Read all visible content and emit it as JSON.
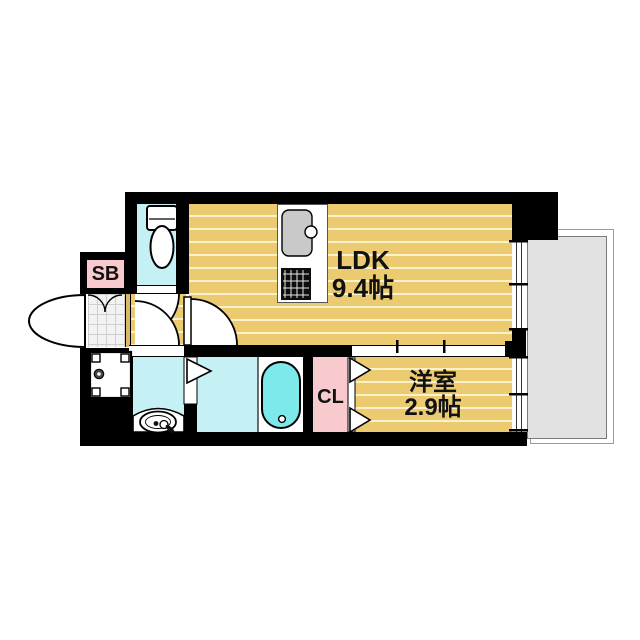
{
  "floorplan": {
    "rooms": {
      "ldk": {
        "label": "LDK",
        "size": "9.4帖"
      },
      "western_room": {
        "label": "洋室",
        "size": "2.9帖"
      },
      "closet": {
        "label": "CL"
      },
      "shoe_box": {
        "label": "SB"
      }
    },
    "icons": {
      "toilet-icon": "toilet fixture",
      "kitchen-sink-icon": "kitchen sink with faucet",
      "gas-stove-icon": "two-burner stove grate",
      "bathtub-icon": "bathtub",
      "washbasin-icon": "washbasin with faucet",
      "washing-machine-pan-icon": "washing machine pan with drain",
      "entrance-door-icon": "entrance door swing arc",
      "interior-door-icon": "hinged door swing arc",
      "folding-door-icon": "folding door triangles",
      "sliding-door-icon": "sliding door with ticks",
      "window-icon": "double-line window",
      "balcony": "balcony slab"
    },
    "colors": {
      "wall": "#000000",
      "floor": "#EBCA70",
      "floor-stripe": "#FBF2CC",
      "water-room": "#C5F1F4",
      "bathtub": "#7EE9EB",
      "closet-pink": "#F8C9CD",
      "balcony-gray": "#E2E2E2",
      "entrance-tile": "#F2F2F2",
      "sink-gray": "#C9C9C9",
      "door-sill": "#D9B868"
    }
  }
}
